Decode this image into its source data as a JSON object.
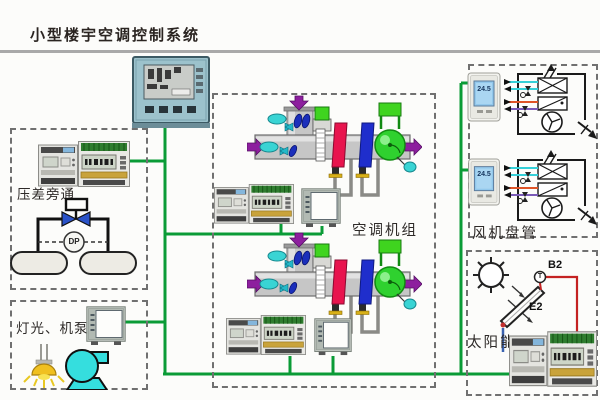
{
  "title": "小型楼宇空调控制系统",
  "network": {
    "line_color": "#0a9b36"
  },
  "pressure_bypass": {
    "label": "压差旁通",
    "dp_sensor": "DP"
  },
  "lighting_pumps": {
    "label": "灯光、机泵"
  },
  "ahu": {
    "label": "空调机组"
  },
  "fan_coil": {
    "label": "风机盘管",
    "thermostat1": {
      "reading": "24.5"
    },
    "thermostat2": {
      "reading": "24.5"
    }
  },
  "solar": {
    "label": "太阳能",
    "temp_sensor": "B2",
    "collector": "E2",
    "t_mark": "T"
  }
}
